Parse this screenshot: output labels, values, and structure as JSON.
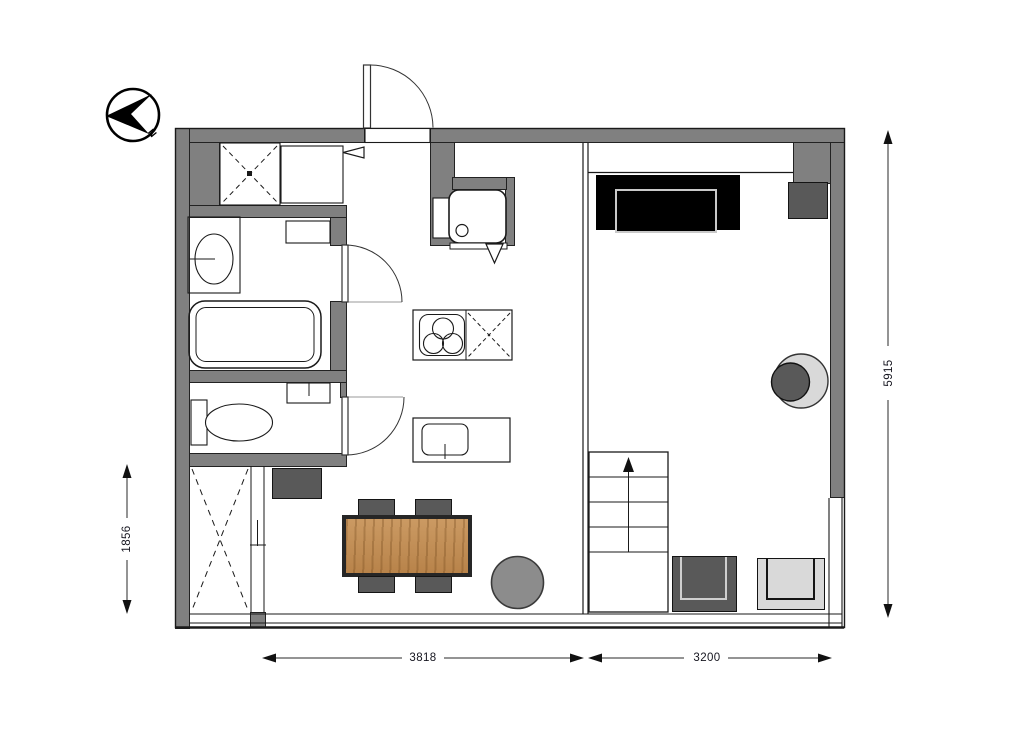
{
  "compass": {
    "label": "N"
  },
  "dimensions": {
    "height_total": "5915",
    "height_room_left": "1856",
    "width_living_left": "3818",
    "width_living_right": "3200"
  },
  "colors": {
    "wall": "#808080",
    "furn_dark": "#595959",
    "furn_light": "#d9d9d9",
    "stool": "#8c8c8c",
    "couch": "#000000",
    "wood": "#c0905a",
    "line": "#1a1a1a"
  },
  "symbols": [
    "compass-north-arrow",
    "entrance-door",
    "bathroom-door",
    "toilet-door",
    "closet-cross",
    "stove-burners",
    "kitchen-sink",
    "island-sink",
    "bathtub",
    "toilet",
    "vanity-basin",
    "staircase-up-arrow",
    "sliding-door",
    "window-band",
    "sofa",
    "dining-table",
    "chairs"
  ]
}
